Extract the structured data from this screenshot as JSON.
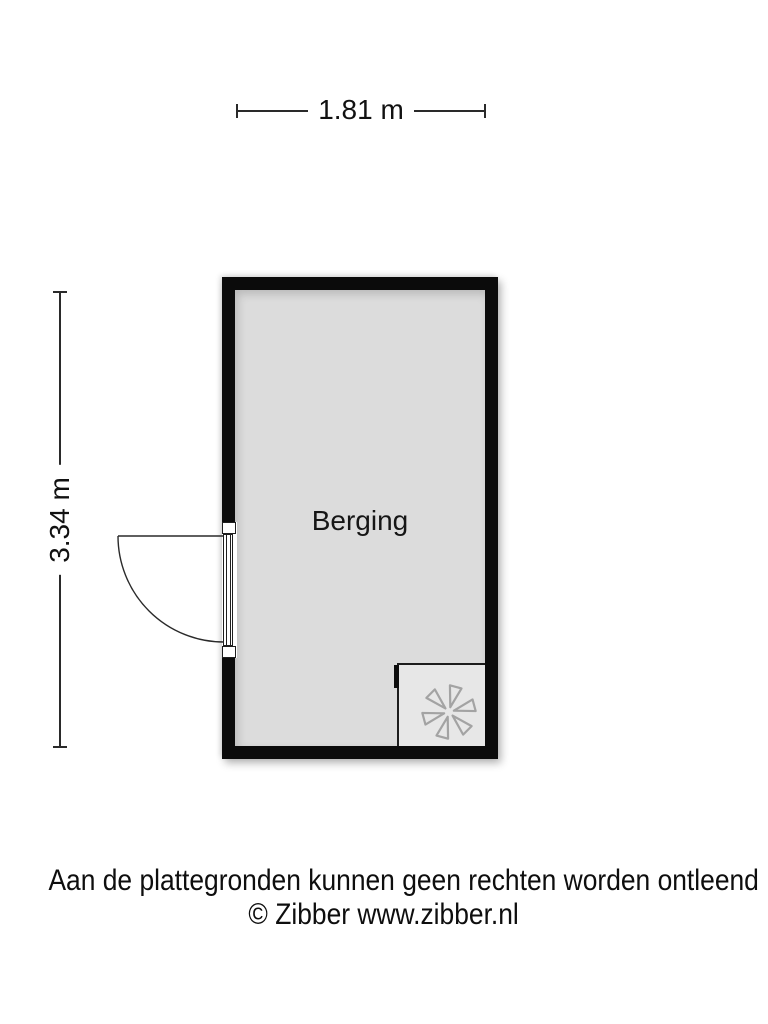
{
  "dimensions": {
    "width_label": "1.81 m",
    "height_label": "3.34 m"
  },
  "room": {
    "name": "Berging",
    "wall_color": "#0b0b0b",
    "floor_color": "#dcdcdc"
  },
  "appliance": {
    "icon": "ventilation-fan-icon",
    "box_color": "#e7e7e7",
    "icon_stroke_color": "#a3a3a3"
  },
  "footer": {
    "disclaimer": "Aan de plattegronden kunnen geen rechten worden ontleend",
    "credit": "© Zibber www.zibber.nl"
  }
}
